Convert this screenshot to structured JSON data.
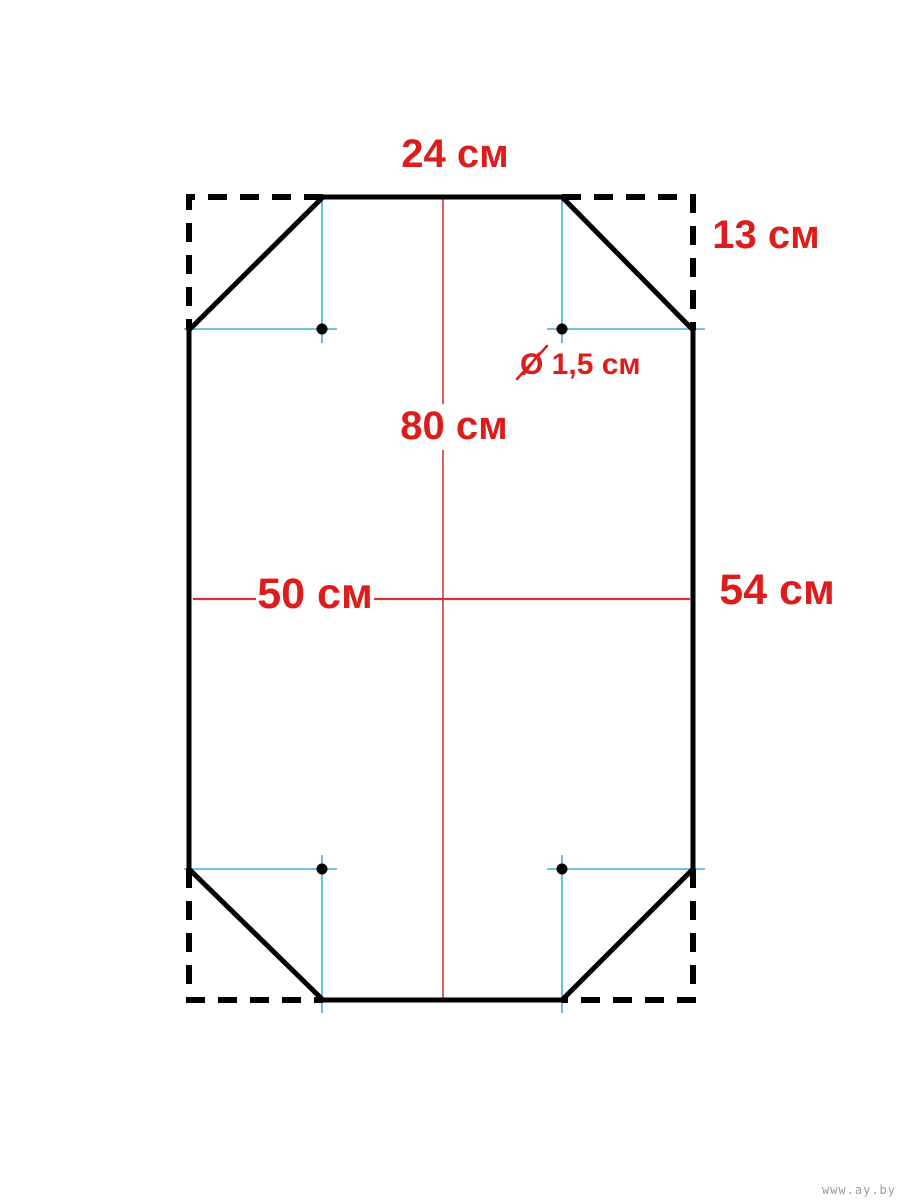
{
  "colors": {
    "background": "#ffffff",
    "outline_black": "#000000",
    "dimension_text_red": "#dd1c1c",
    "centerline_red": "#cf3434",
    "construction_cyan": "#3fb0dc",
    "watermark_gray": "#9a9a9a"
  },
  "labels": {
    "top_width": "24 см",
    "corner_cut": "13 см",
    "center_height": "80 см",
    "hole_diameter": "Ø 1,5 см",
    "inner_width": "50 см",
    "side_height": "54 см"
  },
  "measurements": [
    {
      "name": "top-edge-width",
      "value": "24",
      "unit": "см"
    },
    {
      "name": "corner-cut",
      "value": "13",
      "unit": "см"
    },
    {
      "name": "center-height",
      "value": "80",
      "unit": "см"
    },
    {
      "name": "hole-diameter",
      "value": "1,5",
      "unit": "см"
    },
    {
      "name": "inner-width",
      "value": "50",
      "unit": "см"
    },
    {
      "name": "side-height",
      "value": "54",
      "unit": "см"
    }
  ],
  "watermark": {
    "text": "www.ay.by"
  }
}
